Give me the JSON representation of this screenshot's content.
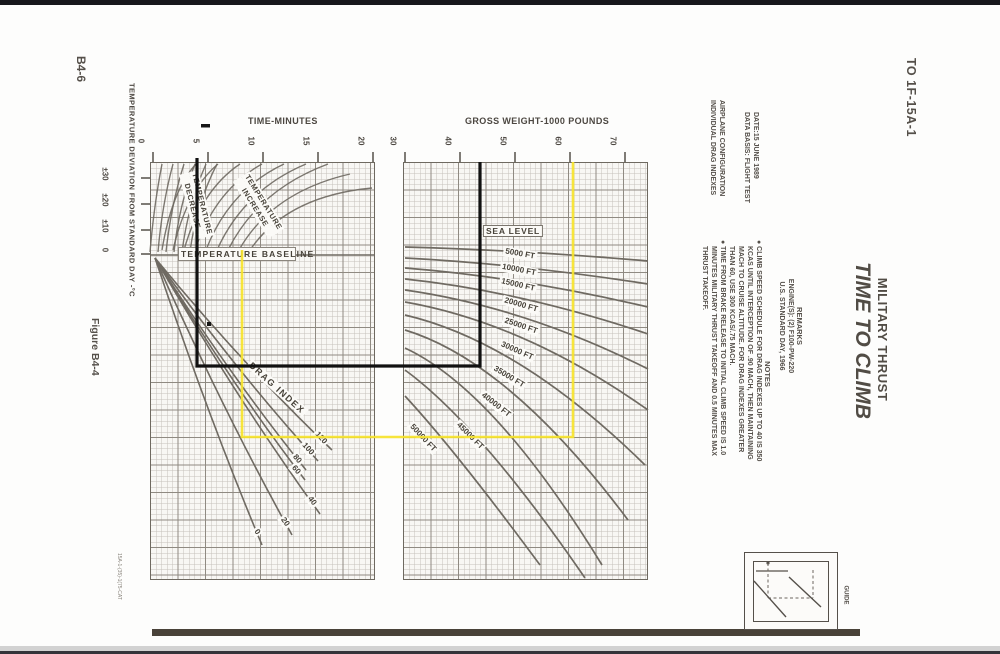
{
  "page": {
    "to_number": "TO 1F-15A-1",
    "page_number": "B4-6",
    "figure_caption": "Figure B4-4",
    "print_code": "15A-1-(35)-1(75-CAT"
  },
  "title_block": {
    "title": "TIME TO CLIMB",
    "subtitle": "MILITARY THRUST"
  },
  "config_block": {
    "line1": "AIRPLANE CONFIGURATION",
    "line2": "INDIVIDUAL DRAG INDEXES",
    "date_line": "DATE:15 JUNE 1989",
    "basis_line": "DATA BASIS: FLIGHT TEST"
  },
  "remarks_block": {
    "heading": "REMARKS",
    "line1": "ENGINE(S): (2) F100-PW-220",
    "line2": "U.S. STANDARD DAY, 1966"
  },
  "notes_block": {
    "heading": "NOTES",
    "bullet1_lines": [
      "● CLIMB SPEED SCHEDULE FOR DRAG INDEXES UP TO 40 IS 350",
      "KCAS UNTIL INTERCEPTION OF .90 MACH, THEN MAINTAINING",
      "MACH TO CRUISE ALTITUDE.  FOR DRAG INDEXES GREATER",
      "THAN 60, USE 300 KCAS/.75 MACH."
    ],
    "bullet2_lines": [
      "● TIME FROM BRAKE RELEASE TO INITIAL CLIMB SPEED IS 1.0",
      "MINUTES MILITARY THRUST TAKEOFF AND 0.5 MINUTES MAX",
      "THRUST TAKEOFF."
    ]
  },
  "left_chart": {
    "axis_title": "TIME-MINUTES",
    "x_ticks": [
      "0",
      "5",
      "10",
      "15",
      "20"
    ],
    "y_axis_title": "TEMPERATURE DEVIATION FROM STANDARD DAY -°C",
    "y_ticks": [
      "±30",
      "±20",
      "±10",
      "0"
    ],
    "baseline_label": "TEMPERATURE BASELINE",
    "decrease_label_line1": "TEMPERATURE",
    "decrease_label_line2": "DECREASE",
    "increase_label_line1": "TEMPERATURE",
    "increase_label_line2": "INCREASE",
    "drag_index_label": "DRAG INDEX",
    "drag_labels": [
      "120",
      "100",
      "80",
      "60",
      "40",
      "20",
      "0"
    ]
  },
  "right_chart": {
    "axis_title": "GROSS WEIGHT-1000 POUNDS",
    "x_ticks": [
      "30",
      "40",
      "50",
      "60",
      "70"
    ],
    "altitude_labels": [
      "SEA LEVEL",
      "5000 FT",
      "10000 FT",
      "15000 FT",
      "20000 FT",
      "25000 FT",
      "30000 FT",
      "35000 FT",
      "40000 FT",
      "45000 FT",
      "50000 FT"
    ]
  },
  "guide": {
    "label": "GUIDE"
  },
  "colors": {
    "trace_black": "#111111",
    "trace_yellow": "#f6e32b",
    "grid_minor": "#c6c2bb",
    "grid_major": "#8f8a82",
    "curve_stroke": "#6f6a62"
  },
  "trace_lines": [
    {
      "color": "black",
      "time_minutes": 4.0,
      "gross_weight_1000_pounds": 43.5
    },
    {
      "color": "yellow",
      "time_minutes": 8.0,
      "gross_weight_1000_pounds": 60.5
    }
  ],
  "chart_data": [
    {
      "type": "line",
      "panel": "time-temperature",
      "title": "TIME TO CLIMB",
      "subtitle": "MILITARY THRUST",
      "xlabel": "TIME-MINUTES",
      "xlim": [
        0,
        20
      ],
      "ylabel": "TEMPERATURE DEVIATION FROM STANDARD DAY -°C",
      "ytick_labels": [
        "±30",
        "±20",
        "±10",
        "0"
      ],
      "grid": true,
      "curve_families": [
        "TEMPERATURE DECREASE",
        "TEMPERATURE INCREASE"
      ],
      "baseline": "TEMPERATURE BASELINE",
      "drag_index_curves": [
        120,
        100,
        80,
        60,
        40,
        20,
        0
      ]
    },
    {
      "type": "line",
      "panel": "gross-weight-altitude",
      "xlabel": "GROSS WEIGHT-1000 POUNDS",
      "xlim": [
        30,
        74
      ],
      "grid": true,
      "altitude_curves": [
        "SEA LEVEL",
        "5000 FT",
        "10000 FT",
        "15000 FT",
        "20000 FT",
        "25000 FT",
        "30000 FT",
        "35000 FT",
        "40000 FT",
        "45000 FT",
        "50000 FT"
      ]
    }
  ]
}
